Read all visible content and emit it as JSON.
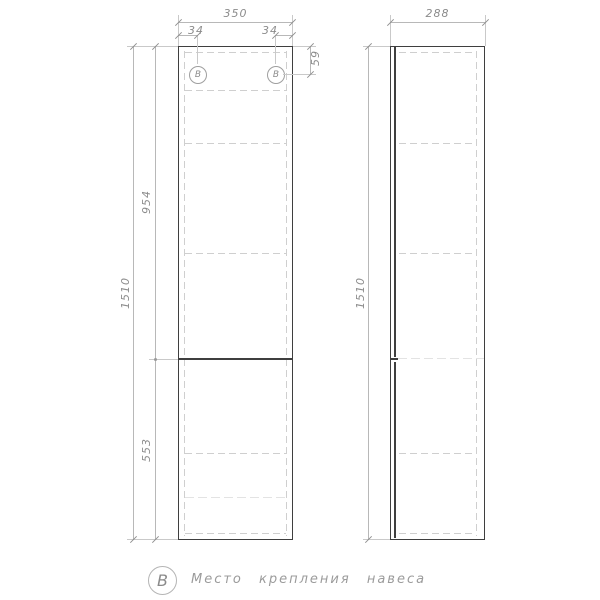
{
  "drawing": {
    "front_view": {
      "dims": {
        "width": "350",
        "left_mount_offset": "34",
        "right_mount_offset": "34",
        "mount_drop": "59",
        "upper_section_height": "954",
        "total_height": "1510",
        "lower_section_height": "553"
      },
      "mount_symbol": "B"
    },
    "side_view": {
      "dims": {
        "depth": "288",
        "total_height": "1510"
      }
    },
    "legend": {
      "symbol": "B",
      "text": "Место крепления навеса"
    },
    "colors": {
      "outline": "#3f3f3f",
      "hidden_line": "#cfcfcf",
      "dimension_line": "#b8b8b8",
      "dimension_text": "#8c8c8c",
      "background": "#ffffff"
    }
  }
}
